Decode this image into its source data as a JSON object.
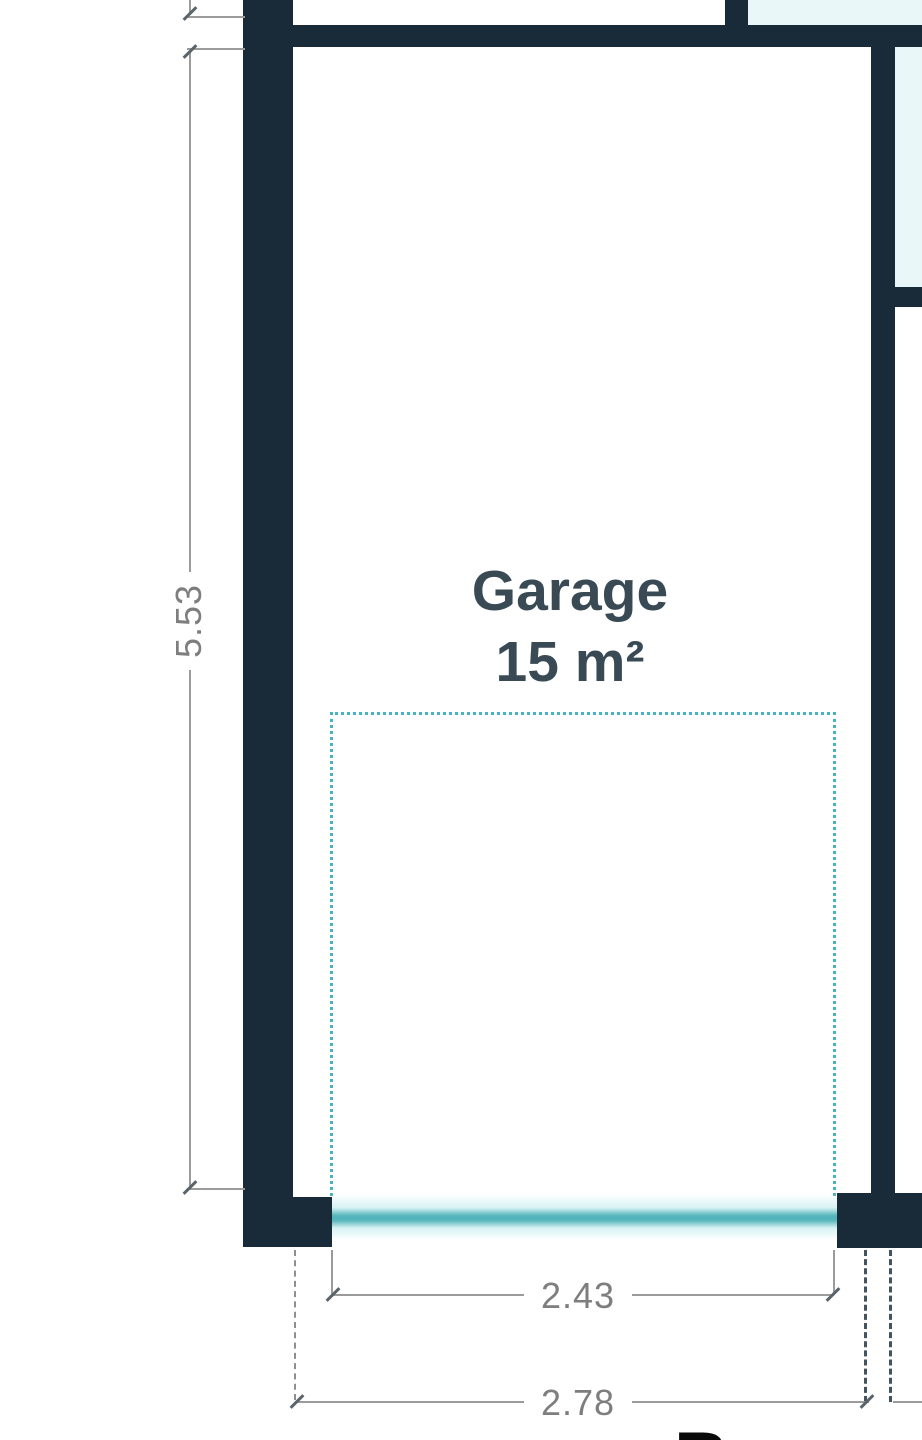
{
  "title": "Floor plan detail",
  "room": {
    "name": "Garage",
    "area": "15 m²"
  },
  "dims": {
    "height": "5.53",
    "door_width": "2.43",
    "opening_width": "2.78"
  },
  "partial": {
    "letter": "B"
  },
  "colors": {
    "wall": "#192a38",
    "door_teal": "#4fb3b9",
    "door_glow": "#d7f2f3",
    "parking_dash": "#45b3c1",
    "glass_fill": "#e9f7f9",
    "dim_line": "#9b9b9b",
    "dim_text": "#7e7e7e",
    "room_label": "#3a4a55"
  }
}
